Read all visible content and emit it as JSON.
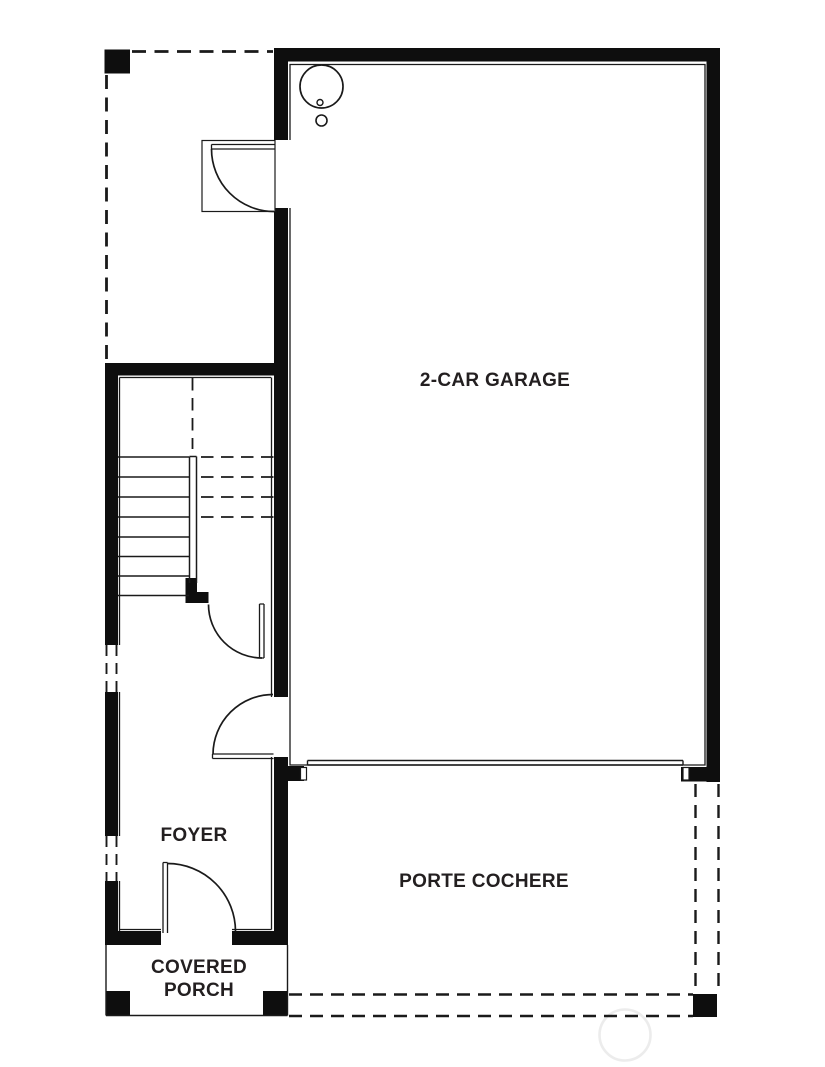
{
  "rooms": {
    "garage": {
      "label": "2-CAR GARAGE"
    },
    "foyer": {
      "label": "FOYER"
    },
    "porte_cochere": {
      "label": "PORTE COCHERE"
    },
    "covered_porch": {
      "label": "COVERED PORCH"
    }
  },
  "colors": {
    "wall": "#0e0e0e",
    "line": "#1a1a1a",
    "text": "#231f20",
    "background": "#ffffff",
    "watermark": "#ececec"
  }
}
